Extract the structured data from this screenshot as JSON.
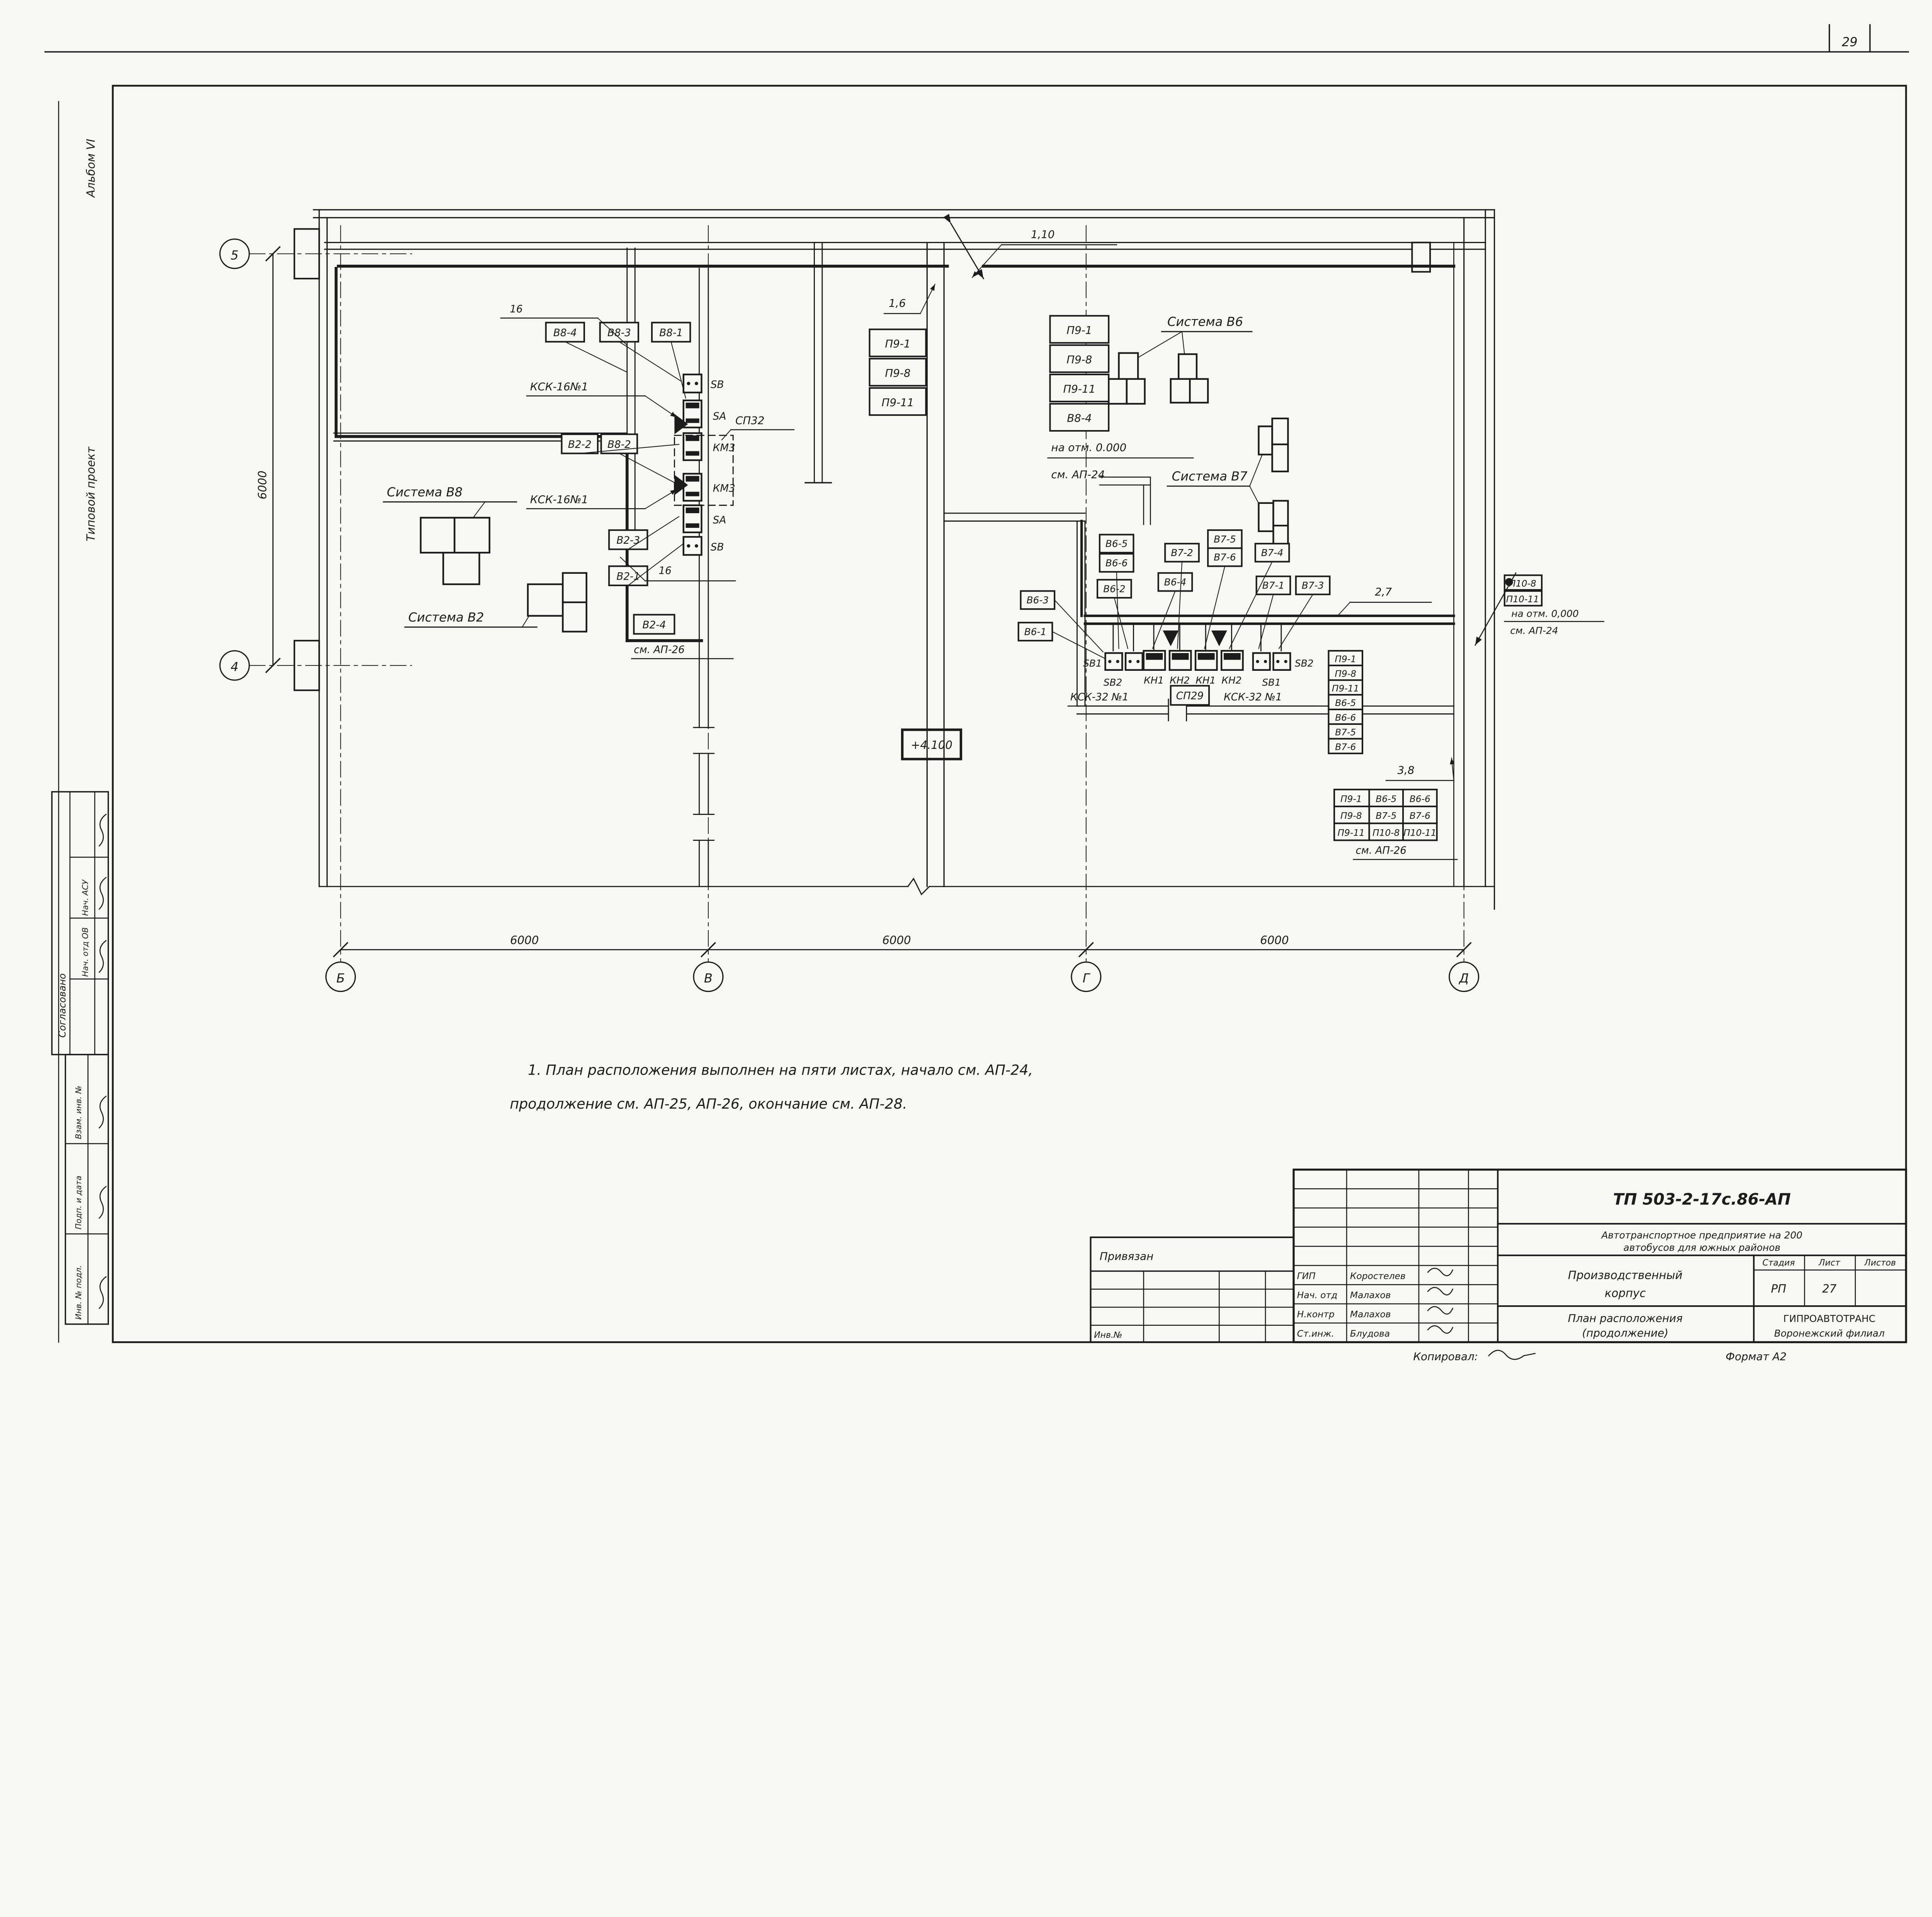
{
  "page": {
    "number": "29",
    "elevation": "+4.100",
    "note1": "1. План расположения выполнен на пяти листах, начало см. АП-24,",
    "note2": "продолжение см. АП-25, АП-26, окончание см. АП-28.",
    "copied": "Копировал:",
    "format": "Формат А2"
  },
  "margin": {
    "album": "Альбом VI",
    "project": "Типовой проект",
    "agreed": "Согласовано",
    "row1": "Нач. АСУ",
    "row2": "Нач. отд ОВ",
    "stamp1": "Взам. инв. №",
    "stamp2": "Подп. и дата",
    "stamp3": "Инв. № подл."
  },
  "axes": {
    "h1": "5",
    "h2": "4",
    "v1": "Б",
    "v2": "В",
    "v3": "Г",
    "v4": "Д",
    "dim1": "6000",
    "dim2": "6000",
    "dim3": "6000",
    "dimv": "6000"
  },
  "systems": {
    "v8": "Система В8",
    "v2": "Система В2",
    "v6": "Система В6",
    "v7": "Система В7"
  },
  "left_cluster": {
    "m16a": "16",
    "m16b": "16",
    "kck1": "КСК-16№1",
    "kck2": "КСК-16№1",
    "sp32": "СП32",
    "dev": [
      "SВ",
      "SA",
      "КМ3",
      "КМ3",
      "SA",
      "SВ"
    ],
    "c": [
      "В8-4",
      "В8-3",
      "В8-1",
      "В2-2",
      "В8-2",
      "В2-3",
      "В2-1",
      "В2-4"
    ],
    "see26": "см. АП-26"
  },
  "top_stacks": {
    "m16": "1,6",
    "m110": "1,10",
    "s1": [
      "П9-1",
      "П9-8",
      "П9-11"
    ],
    "s2": [
      "П9-1",
      "П9-8",
      "П9-11",
      "В8-4"
    ],
    "elev": "на отм. 0.000",
    "see24": "см. АП-24"
  },
  "bottom_cluster": {
    "c": [
      "В6-3",
      "В6-1",
      "В6-5",
      "В6-6",
      "В6-2",
      "В6-4",
      "В7-2",
      "В7-5",
      "В7-6",
      "В7-4",
      "В7-1",
      "В7-3"
    ],
    "dev": [
      "SВ1",
      "SВ2",
      "КН1",
      "КН2",
      "КН1",
      "КН2",
      "SВ1",
      "SВ2"
    ],
    "kck1": "КСК-32 №1",
    "sp29": "СП29",
    "kck2": "КСК-32 №1",
    "m27": "2,7",
    "stack": [
      "П9-1",
      "П9-8",
      "П9-11",
      "В6-5",
      "В6-6",
      "В7-5",
      "В7-6"
    ],
    "m38": "3,8",
    "grid": [
      [
        "П9-1",
        "В6-5",
        "В6-6"
      ],
      [
        "П9-8",
        "В7-5",
        "В7-6"
      ],
      [
        "П9-11",
        "П10-8",
        "П10-11"
      ]
    ],
    "see26": "см. АП-26"
  },
  "right_callout": {
    "b1": "П10-8",
    "b2": "П10-11",
    "elev": "на отм. 0,000",
    "see24": "см. АП-24"
  },
  "title_block": {
    "doc": "ТП 503-2-17с.86-АП",
    "object1": "Автотранспортное предприятие на 200",
    "object2": "автобусов для южных районов",
    "building1": "Производственный",
    "building2": "корпус",
    "sheet_title1": "План расположения",
    "sheet_title2": "(продолжение)",
    "stage_h": "Стадия",
    "sheet_h": "Лист",
    "sheets_h": "Листов",
    "stage": "РП",
    "sheet": "27",
    "org1": "ГИПРОАВТОТРАНС",
    "org2": "Воронежский филиал",
    "roles": [
      "ГИП",
      "Нач. отд",
      "Н.контр",
      "Ст.инж."
    ],
    "names": [
      "Коростелев",
      "Малахов",
      "Малахов",
      "Блудова"
    ],
    "attached": "Привязан",
    "inv": "Инв.№"
  }
}
